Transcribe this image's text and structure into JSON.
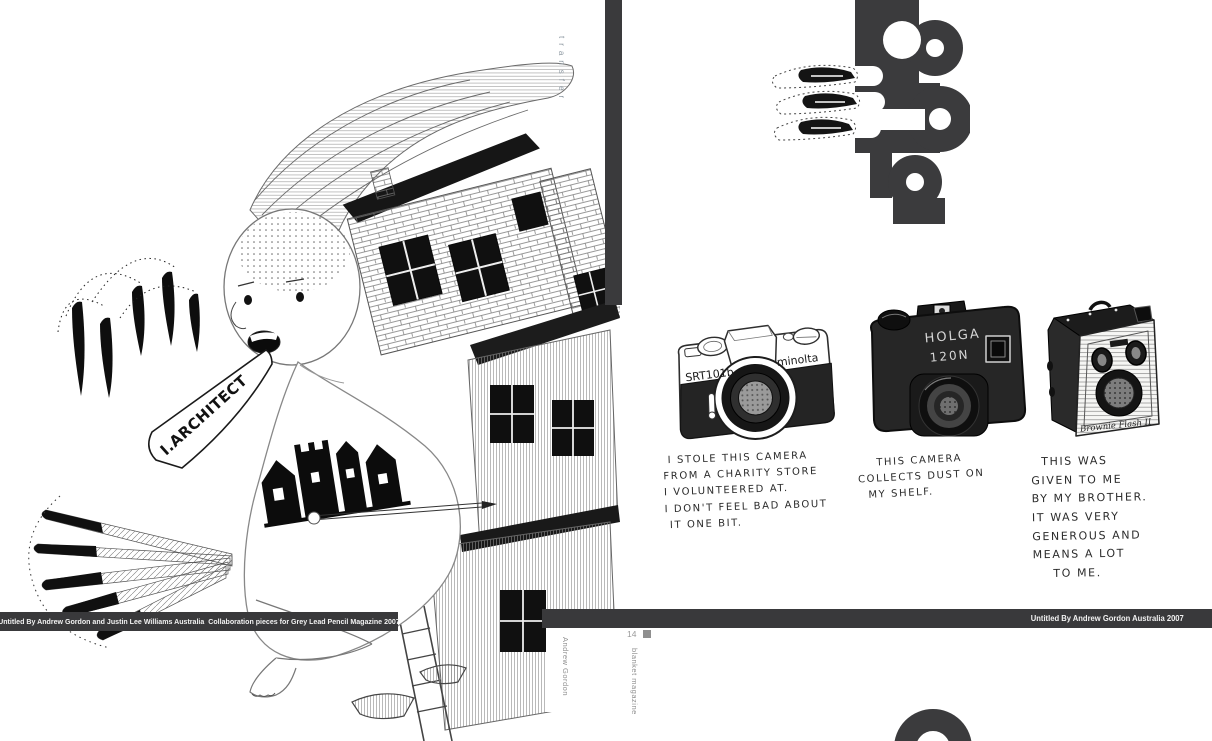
{
  "colors": {
    "bar": "#39393b",
    "letterform": "#3b3b3d",
    "muted_text": "#8f8f8f",
    "transfer_text": "#8f9aa3",
    "ink": "#1a1a1a"
  },
  "left_page": {
    "caption": "Untitled By Andrew Gordon and Justin Lee Williams Australia  Collaboration pieces for Grey Lead Pencil Magazine 2007",
    "speech_text": "I.ARCHITECT",
    "sidebar_label": "transfer",
    "artist_credit": "Andrew Gordon"
  },
  "gutter": {
    "page_number": "14",
    "magazine_title": "blanket magazine"
  },
  "right_page": {
    "caption": "Untitled By Andrew Gordon Australia 2007",
    "typography_letters": "an",
    "cameras": [
      {
        "model_left": "SRT101b",
        "model_right": "minolta",
        "caption_lines": [
          " I STOLE THIS CAMERA",
          "FROM A CHARITY STORE",
          "I VOLUNTEERED AT.",
          "I DON'T FEEL BAD ABOUT",
          " IT ONE BIT."
        ]
      },
      {
        "model_line1": "HOLGA",
        "model_line2": "120N",
        "caption_lines": [
          "    THIS CAMERA",
          "COLLECTS DUST ON",
          "  MY SHELF."
        ]
      },
      {
        "model": "Brownie Flash II",
        "caption_lines": [
          "  THIS WAS",
          "GIVEN TO ME",
          "BY MY BROTHER.",
          "IT WAS VERY",
          "GENEROUS AND",
          "MEANS A LOT",
          "    TO ME."
        ]
      }
    ]
  }
}
